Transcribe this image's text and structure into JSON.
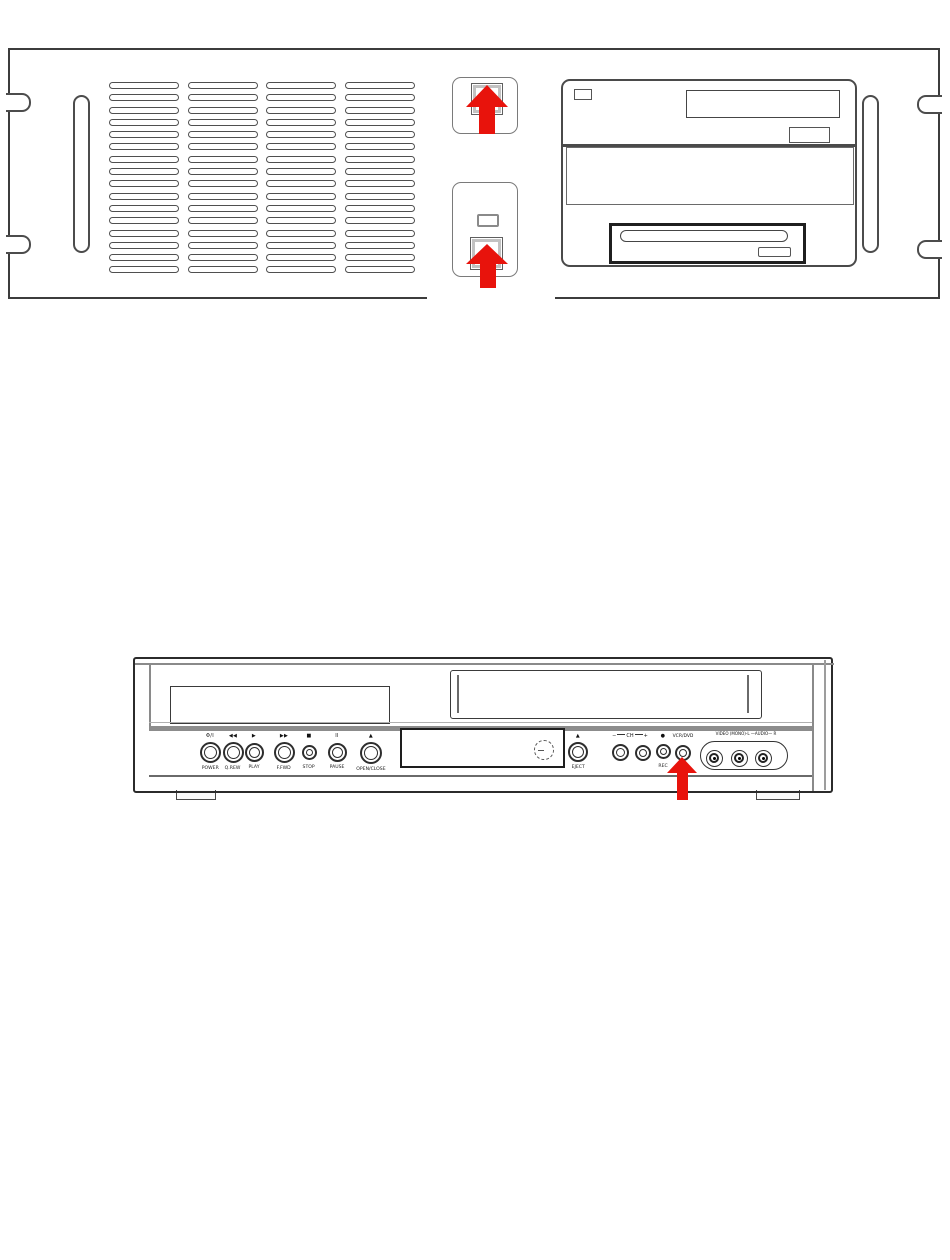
{
  "page": {
    "background": "#ffffff",
    "kind": "hardware manual illustration"
  },
  "highlight": {
    "arrow_color": "#e8130c",
    "arrow_direction": "up",
    "arrow_count": 3
  },
  "rack_unit": {
    "description": "rack-mount chassis front panel",
    "vent_grille": {
      "columns": 4,
      "rows": 16
    }
  },
  "vcr_unit": {
    "description": "VCR/DVD combo front panel",
    "transport_buttons": [
      {
        "symbol": "Φ/I",
        "label": "POWER"
      },
      {
        "symbol": "◀◀",
        "label": "Q.REW"
      },
      {
        "symbol": "▶",
        "label": "PLAY"
      },
      {
        "symbol": "▶▶",
        "label": "F.FWD"
      },
      {
        "symbol": "■",
        "label": "STOP"
      },
      {
        "symbol": "II",
        "label": "PAUSE"
      },
      {
        "symbol": "▲",
        "label": "OPEN/CLOSE"
      }
    ],
    "eject": {
      "symbol": "▲",
      "label": "EJECT"
    },
    "channel": {
      "minus": "−",
      "label": "CH",
      "plus": "+"
    },
    "rec": {
      "symbol": "●",
      "label": "REC"
    },
    "selector": {
      "label": "VCR/DVD"
    },
    "jacks": {
      "label": "VIDEO (MONO)-L —AUDIO— R"
    }
  }
}
